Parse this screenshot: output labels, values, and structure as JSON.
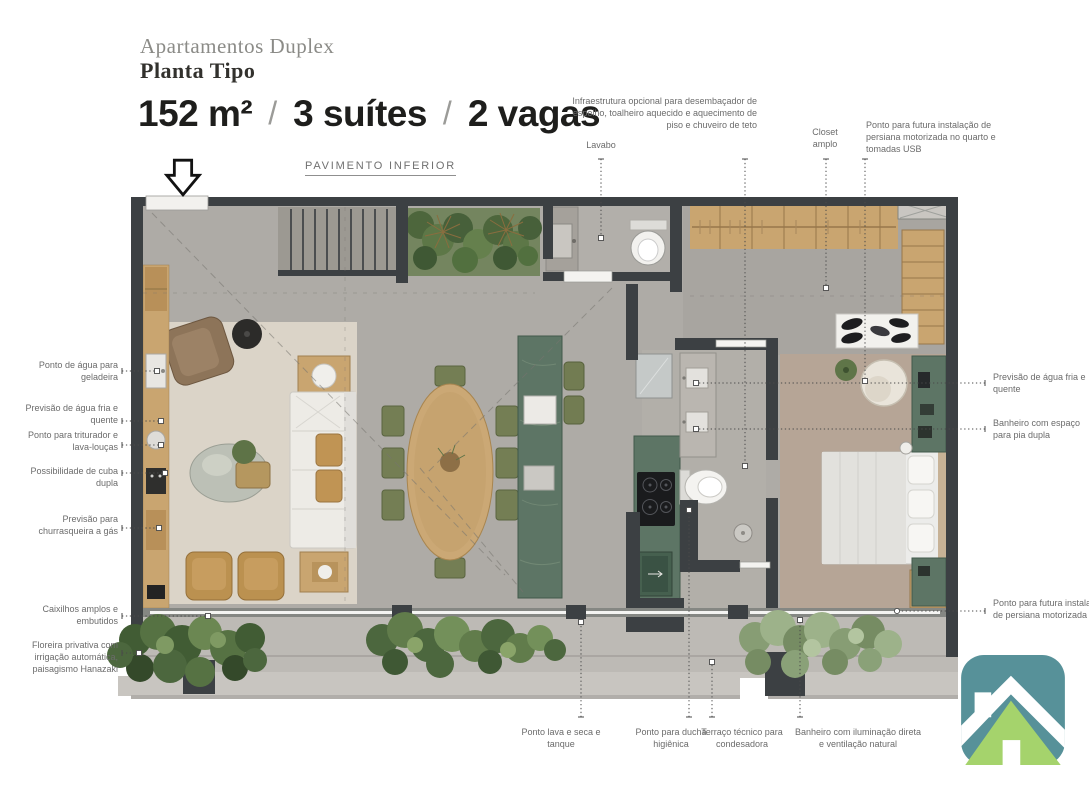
{
  "header": {
    "title": "Apartamentos Duplex",
    "subtitle": "Planta Tipo",
    "specs": {
      "area": "152 m²",
      "suites": "3 suítes",
      "parking": "2 vagas",
      "separator": "/"
    },
    "floor_label": "PAVIMENTO INFERIOR"
  },
  "callouts": {
    "left": [
      "Ponto de água para geladeira",
      "Previsão de água fria e quente",
      "Ponto para triturador e lava-louças",
      "Possibilidade de cuba dupla",
      "Previsão para churrasqueira a gás",
      "Caixilhos amplos e embutidos",
      "Floreira privativa com irrigação automática, paisagismo Hanazaki"
    ],
    "top": [
      "Lavabo",
      "Infraestrutura opcional para desembaçador de espelho, toalheiro aquecido e aquecimento de piso e chuveiro de teto",
      "Closet amplo",
      "Ponto para futura instalação de persiana motorizada no quarto e tomadas USB"
    ],
    "right": [
      "Previsão de água fria e quente",
      "Banheiro com espaço para pia dupla",
      "Ponto para futura instalação de persiana motorizada"
    ],
    "bottom": [
      "Ponto lava e seca e tanque",
      "Ponto para ducha higiênica",
      "Terraço técnico para condesadora",
      "Banheiro com iluminação direta e ventilação natural"
    ]
  },
  "colors": {
    "wall": "#3c4043",
    "floor": "#aeaba6",
    "rug_living": "#dbd4c8",
    "rug_bedroom": "#b6a596",
    "wood": "#c9a570",
    "marble_green": "#5d7565",
    "greenery": "#4c673e",
    "balcony": "#bdbab5",
    "logo_teal": "#579199",
    "logo_green": "#a5d36c",
    "text_dark": "#1e1e1c",
    "label_gray": "#6b6b6b"
  }
}
